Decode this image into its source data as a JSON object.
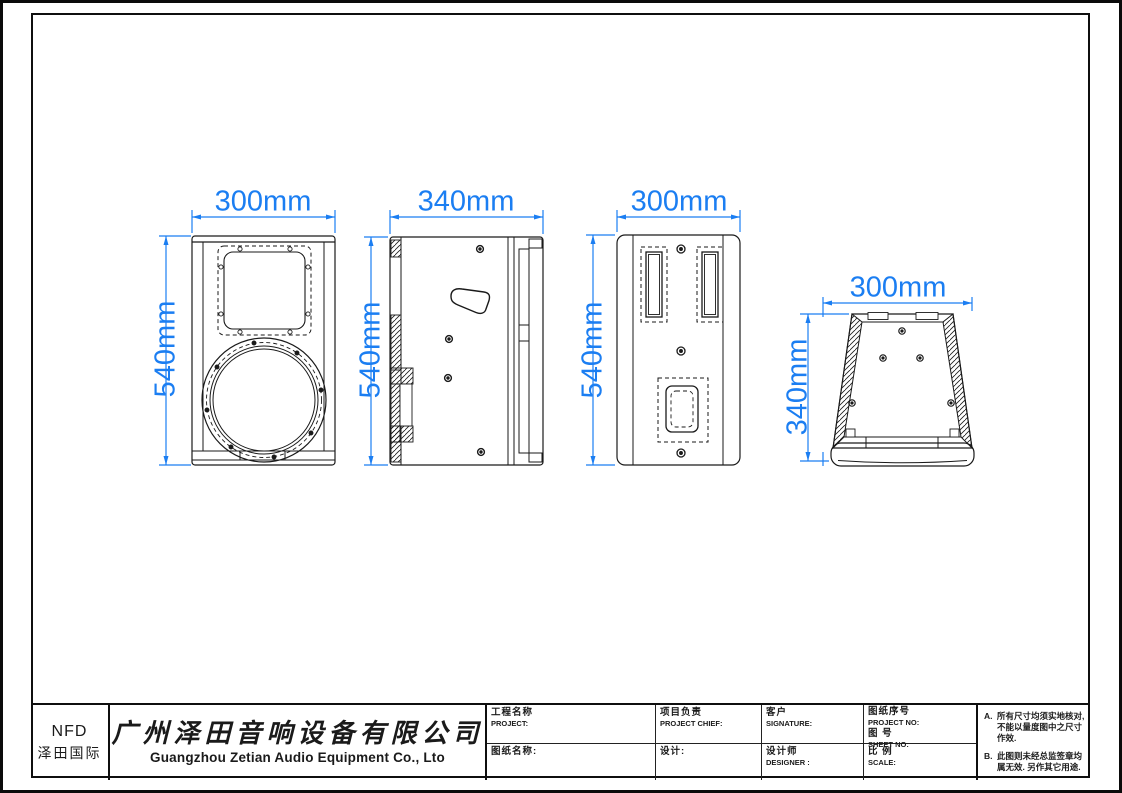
{
  "company": {
    "logo_top": "NFD",
    "logo_bottom": "泽田国际",
    "name_cn": "广州泽田音响设备有限公司",
    "name_en": "Guangzhou Zetian Audio Equipment Co., Lto"
  },
  "title_block": {
    "project_cn": "工程名称",
    "project_en": "PROJECT:",
    "drawing_name": "图纸名称:",
    "chief_cn": "项目负责",
    "chief_en": "PROJECT CHIEF:",
    "design": "设计:",
    "client_cn": "客户",
    "client_en": "SIGNATURE:",
    "designer_cn": "设计师",
    "designer_en": "DESIGNER :",
    "project_no_cn": "图纸序号",
    "project_no_en": "PROJECT NO:",
    "sheet_no_cn": "图  号",
    "sheet_no_en": "SHEET  NO:",
    "scale_cn": "比 例",
    "scale_en": "SCALE:"
  },
  "notes": {
    "items": [
      {
        "id": "A.",
        "text": "所有尺寸均须实地核对, 不能以量度图中之尺寸作效."
      },
      {
        "id": "B.",
        "text": "此图则未经总监签章均属无效. 另作其它用途."
      }
    ]
  },
  "views": {
    "front": {
      "width": "300mm",
      "height": "540mm"
    },
    "side": {
      "width": "340mm",
      "height": "540mm"
    },
    "back": {
      "width": "300mm",
      "height": "540mm"
    },
    "top": {
      "width": "300mm",
      "depth": "340mm"
    }
  },
  "colors": {
    "dimension_blue": "#1b7ef2",
    "line_black": "#1a1a1a"
  }
}
